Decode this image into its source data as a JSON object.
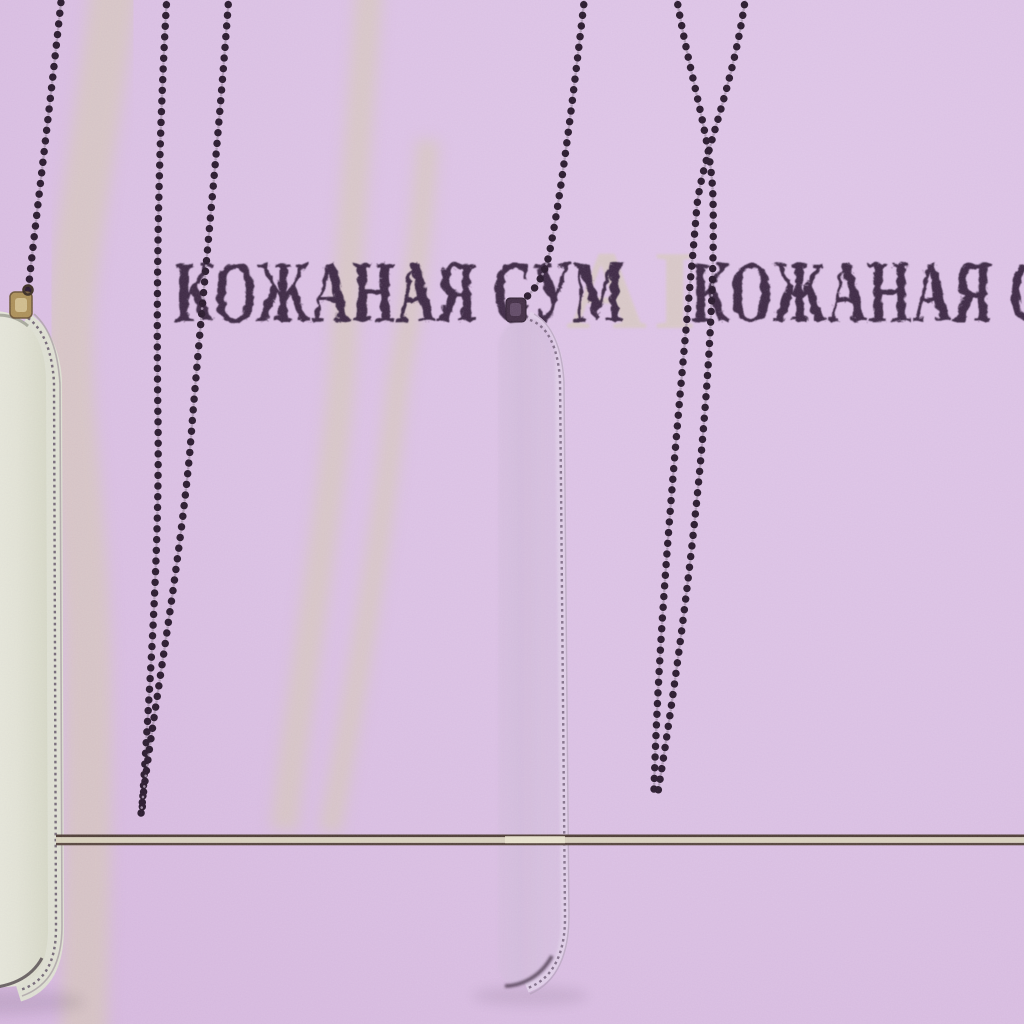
{
  "image": {
    "kind": "product-photo",
    "background_color": "#dcc2e5",
    "caption_row": {
      "font_color": "#3b2842",
      "instances": [
        {
          "text": "КОЖАНАЯ СУМ"
        },
        {
          "text": "КОЖАНАЯ СУМ"
        }
      ]
    },
    "background_watermark": {
      "partial_letters": "АІ",
      "color": "#d5cdaa"
    },
    "objects": {
      "left_bag": {
        "label": "cream leather zip pouch",
        "leather_color": "#e3e4d6",
        "hardware_color": "#ab8f55"
      },
      "center_bag": {
        "label": "lilac leather zip pouch",
        "leather_color": "#d4bedd",
        "hardware_color": "#3f2b42"
      },
      "chains": {
        "label": "dark bead chain straps",
        "color": "#261729"
      },
      "divider_line": {
        "label": "thin double horizontal line",
        "dark_color": "#4c3b33",
        "light_color": "#d8d2ba"
      }
    }
  }
}
